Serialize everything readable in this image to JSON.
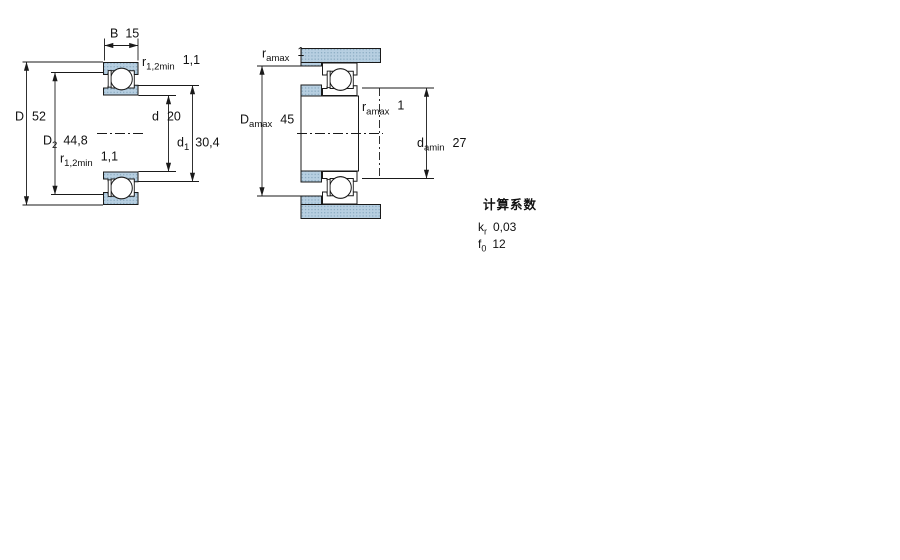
{
  "drawing": {
    "title": "deep groove ball bearing dimension drawing",
    "figure1": {
      "name": "bearing cross-section",
      "dims": {
        "B": {
          "symbol": "B",
          "value": "15"
        },
        "r_top": {
          "symbol": "r",
          "sub": "1,2min",
          "value": "1,1"
        },
        "D": {
          "symbol": "D",
          "value": "52"
        },
        "D2": {
          "symbol": "D",
          "sub": "2",
          "value": "44,8"
        },
        "r_bottom": {
          "symbol": "r",
          "sub": "1,2min",
          "value": "1,1"
        },
        "d": {
          "symbol": "d",
          "value": "20"
        },
        "d1": {
          "symbol": "d",
          "sub": "1",
          "value": "30,4"
        }
      }
    },
    "figure2": {
      "name": "abutment and fillet dimensions",
      "dims": {
        "ra_top": {
          "symbol": "r",
          "sub": "amax",
          "value": "1"
        },
        "Da": {
          "symbol": "D",
          "sub": "amax",
          "value": "45"
        },
        "ra_right": {
          "symbol": "r",
          "sub": "amax",
          "value": "1"
        },
        "da": {
          "symbol": "d",
          "sub": "amin",
          "value": "27"
        }
      }
    },
    "calculation_factors": {
      "title": "计算系数",
      "rows": [
        {
          "symbol": "k",
          "sub": "r",
          "value": "0,03"
        },
        {
          "symbol": "f",
          "sub": "0",
          "value": "12"
        }
      ]
    },
    "colors": {
      "hatch_fill": "#b7cfe1",
      "hatch_dot": "#7da0b8",
      "line_color": "#1a1a1a"
    }
  }
}
